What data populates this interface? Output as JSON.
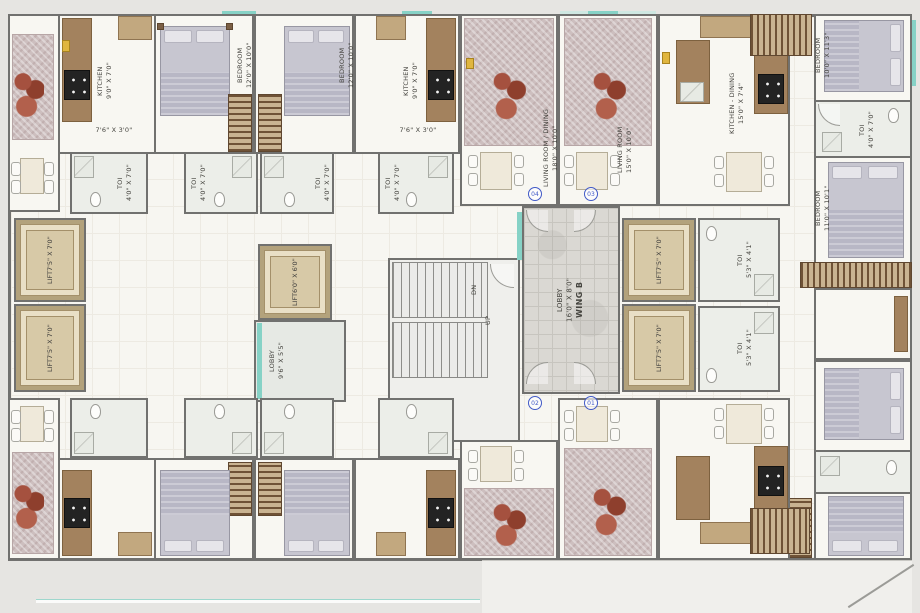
{
  "rooms": {
    "kitchen": {
      "name": "KITCHEN",
      "dim": "9'0\" X 7'0\""
    },
    "bedroom_12x10": {
      "name": "BEDROOM",
      "dim": "12'0\" X 10'0\""
    },
    "toi_4x7": {
      "name": "TOI",
      "dim": "4'0\" X 7'0\""
    },
    "toi_5x4": {
      "name": "TOI",
      "dim": "5'3\" X 4'1\""
    },
    "living_dining": {
      "name": "LIVING ROOM / DINING",
      "dim": "18'0\" X 10'0\""
    },
    "living": {
      "name": "LIVING ROOM",
      "dim": "15'0\" X 10'0\""
    },
    "kitchen_dining": {
      "name": "KITCHEN - DINING",
      "dim": "15'0\" X 7'4\""
    },
    "bedroom_10x11": {
      "name": "BEDROOM",
      "dim": "10'0\" X 11'3\""
    },
    "bedroom_11x10": {
      "name": "BEDROOM",
      "dim": "11'0\" X 10'1\""
    },
    "lift_main": {
      "name": "LIFT",
      "dim": "7'5\" X 7'0\""
    },
    "lift_small": {
      "name": "LIFT",
      "dim": "6'0\" X 6'0\""
    },
    "lobby_small": {
      "name": "LOBBY",
      "dim": "9'6\" X 5'5\""
    },
    "lobby_main": {
      "name": "LOBBY",
      "dim": "16'0\" X 8'0\"",
      "wing": "WING B"
    },
    "passage": {
      "dim": "7'6\" X 3'0\""
    }
  },
  "stairs": {
    "down": "DN",
    "up": "UP"
  },
  "unit_numbers": {
    "u01": "01",
    "u02": "02",
    "u03": "03",
    "u04": "04"
  },
  "colors": {
    "wall": "#71716f",
    "floor": "#f7f6f1",
    "teal_accent": "#86d2c6",
    "lift_cabin": "#d7c9a7",
    "unit_number_blue": "#4059c7",
    "furniture_brown": "#a3825e",
    "carpet": "#cdbfbf"
  }
}
